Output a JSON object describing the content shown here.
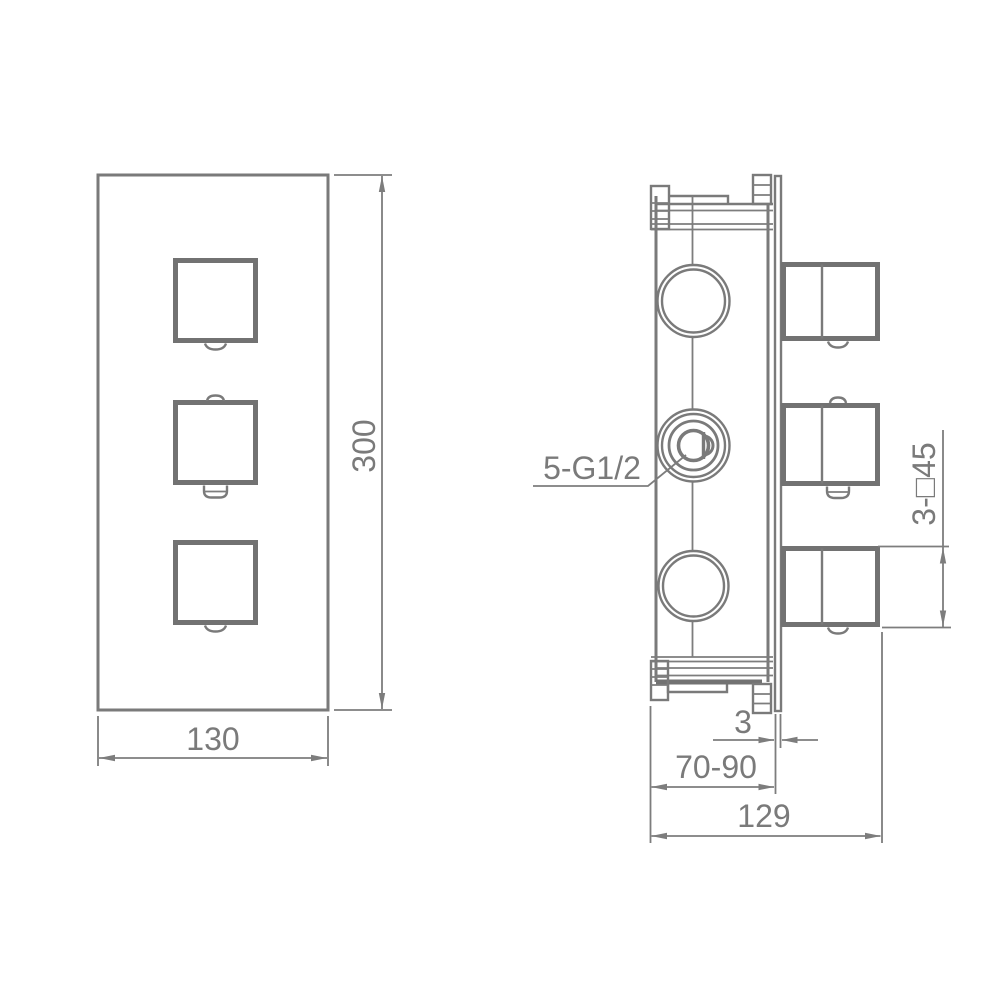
{
  "colors": {
    "line": "#7a7a7a",
    "dimension_line": "#7d7d7d",
    "heavy_line": "#727272",
    "background": "#ffffff"
  },
  "front_view": {
    "width_dim": "130",
    "height_dim": "300"
  },
  "side_view": {
    "port_thread_label": "5-G1/2",
    "handle_square_label": "3-□45",
    "plate_thickness_dim": "3",
    "mounting_depth_dim": "70-90",
    "overall_depth_dim": "129"
  }
}
